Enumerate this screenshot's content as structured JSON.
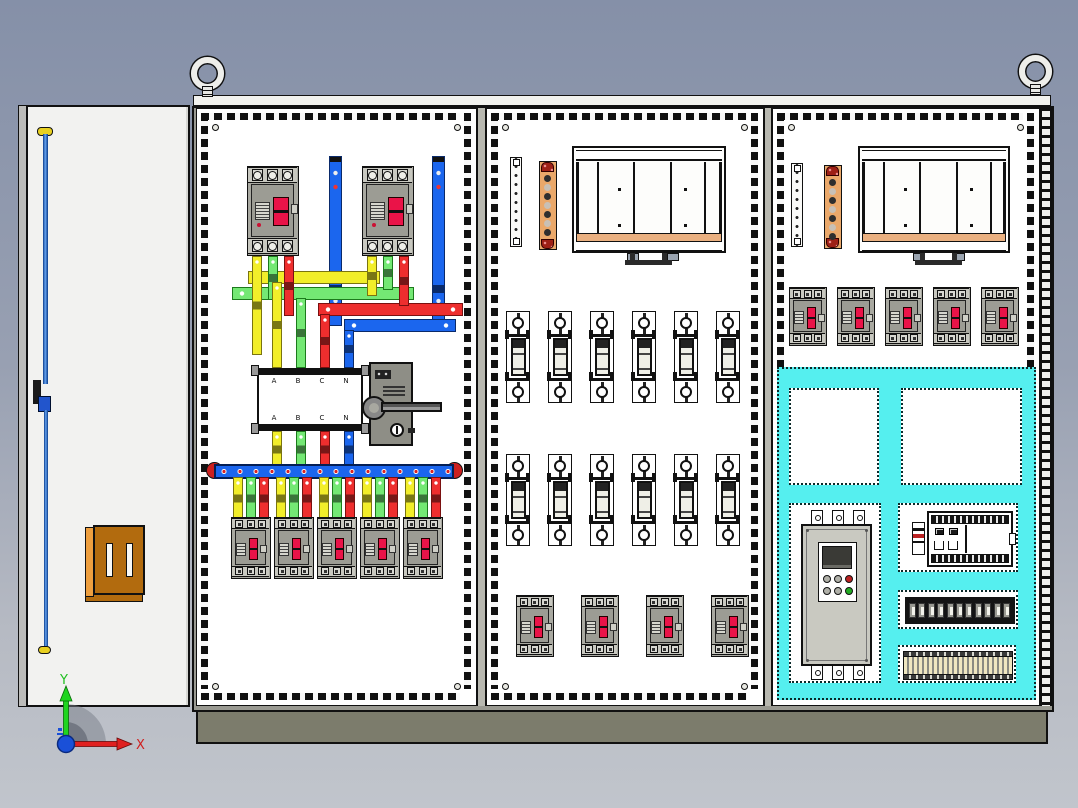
{
  "view": {
    "type": "3d-cad-assembly",
    "subject": "Three-bay low-voltage electrical distribution cabinet with open side door",
    "selection_note": "Control sub-assembly in right bay highlighted cyan"
  },
  "axis_triad": {
    "y_label": "Y",
    "x_label": "X"
  },
  "busbar_support": {
    "phase_labels": [
      "A",
      "B",
      "C",
      "N"
    ]
  },
  "colors": {
    "background_top": "#8590a8",
    "background_bottom": "#c1c5cc",
    "selection_cyan": "#55efef",
    "busbar_blue": "#1b66ee",
    "phase_yellow": "#f2ee2a",
    "phase_green": "#74e874",
    "phase_red": "#ee2e2e",
    "copper_bar": "#eaa86a",
    "breaker_rocker_red": "#ea1348",
    "plinth_olive": "#7c7c6c",
    "door_pocket_brown": "#b26b0e"
  },
  "inventory": {
    "lifting_eye_bolts": 2,
    "door": {
      "interlock_rods": 2,
      "document_pocket": 1
    },
    "bay1": {
      "incoming_breakers": 2,
      "vertical_feeder_bars": 2,
      "phase_crossover_bars": 4,
      "busbar_support_frames": 1,
      "disconnect_switch": 1,
      "main_distribution_busbar": 1,
      "outgoing_breakers": 5
    },
    "bay2": {
      "terminal_strips": 1,
      "copper_earth_bars": 1,
      "mounting_frames": 1,
      "fuse_rows": 2,
      "fuses_per_row": 6,
      "outgoing_breakers": 4
    },
    "bay3": {
      "terminal_strips": 1,
      "copper_earth_bars": 1,
      "mounting_frames": 1,
      "outgoing_breakers": 5,
      "selected_fuses": 3,
      "fan_cooled_power_units": 2,
      "soft_starter": 1,
      "plc_controller": 1,
      "relay_modules": 11,
      "terminal_block_strips": 1
    }
  }
}
